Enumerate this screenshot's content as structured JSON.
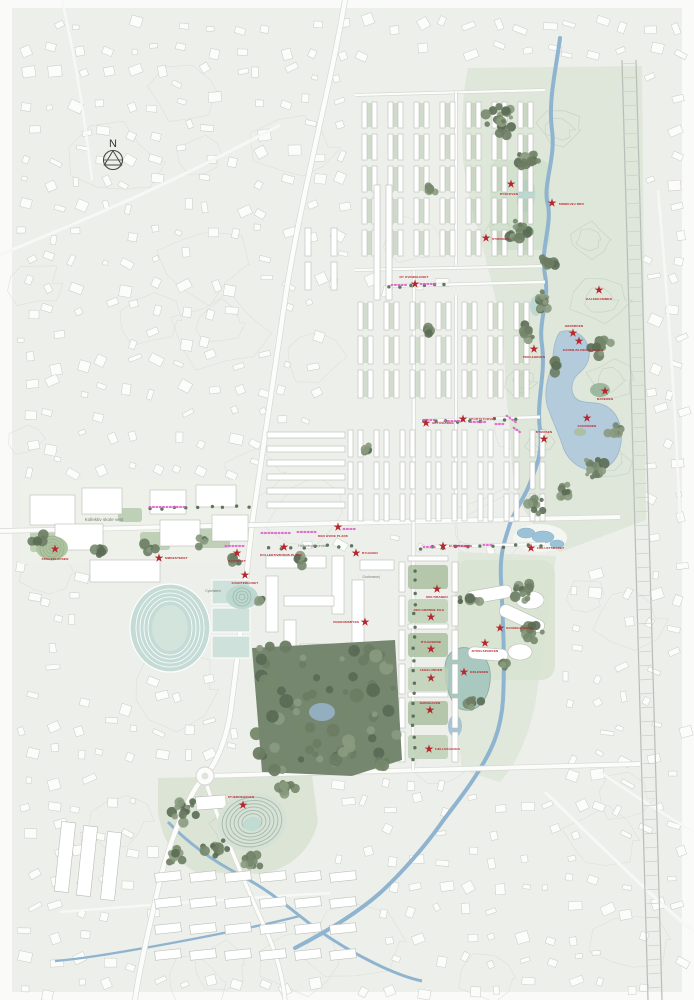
{
  "map": {
    "title": "masterplan-site-map",
    "compass": {
      "label": "N"
    },
    "colors": {
      "page_bg": "#fafaf8",
      "map_bg": "#edefeb",
      "accent_red": "#b5272d",
      "pink": "#dd5fc9",
      "river": "#8fb4cf",
      "lake": "#b3cbdb",
      "teal_pond": "#bcd8d0",
      "park_green": "#dfe6da",
      "forest_green": "#76876f",
      "building_fill": "#ffffff",
      "building_stroke": "#b8bdb6",
      "contour": "#d9dcd5"
    },
    "area_labels": [
      {
        "x": 104,
        "y": 521,
        "text": "Kollektiv skole vest",
        "size": 4.6
      },
      {
        "x": 313,
        "y": 547,
        "text": "Helhedsplancentret",
        "size": 3.4
      },
      {
        "x": 371,
        "y": 578,
        "text": "Gudrunsvej",
        "size": 3.4
      },
      {
        "x": 213,
        "y": 592,
        "text": "Cykelstien",
        "size": 3.4
      }
    ],
    "star_markers": [
      {
        "x": 511,
        "y": 184,
        "label": "BYSKOVEN",
        "lx": 509,
        "ly": 195,
        "anchor": "middle"
      },
      {
        "x": 552,
        "y": 203,
        "label": "MINDEVEJ BRO",
        "lx": 559,
        "ly": 205,
        "anchor": "start"
      },
      {
        "x": 486,
        "y": 238,
        "label": "STIBROEN",
        "lx": 492,
        "ly": 240,
        "anchor": "start"
      },
      {
        "x": 415,
        "y": 284,
        "label": "NY KVINDEHUSET",
        "lx": 414,
        "ly": 278,
        "anchor": "middle"
      },
      {
        "x": 599,
        "y": 290,
        "label": "KALKEDAMMEN",
        "lx": 599,
        "ly": 300,
        "anchor": "middle"
      },
      {
        "x": 573,
        "y": 333,
        "label": "HØJBROEN",
        "lx": 574,
        "ly": 327,
        "anchor": "middle"
      },
      {
        "x": 579,
        "y": 341,
        "label": "KAREN-BLIXENPLADSEN",
        "lx": 583,
        "ly": 351,
        "anchor": "middle"
      },
      {
        "x": 534,
        "y": 349,
        "label": "PERLEHØJEN",
        "lx": 534,
        "ly": 358,
        "anchor": "middle"
      },
      {
        "x": 605,
        "y": 391,
        "label": "BADEØEN",
        "lx": 605,
        "ly": 400,
        "anchor": "middle"
      },
      {
        "x": 587,
        "y": 418,
        "label": "KANOSØEN",
        "lx": 587,
        "ly": 427,
        "anchor": "middle"
      },
      {
        "x": 426,
        "y": 423,
        "label": "AKTIVGADEN",
        "lx": 432,
        "ly": 424,
        "anchor": "start"
      },
      {
        "x": 463,
        "y": 419,
        "label": "SPORTSTORVET",
        "lx": 469,
        "ly": 420,
        "anchor": "start"
      },
      {
        "x": 544,
        "y": 439,
        "label": "BYMOSEN",
        "lx": 544,
        "ly": 433,
        "anchor": "middle"
      },
      {
        "x": 338,
        "y": 527,
        "label": "DEN HVIDE PLADS",
        "lx": 333,
        "ly": 537,
        "anchor": "middle"
      },
      {
        "x": 443,
        "y": 546,
        "label": "KUNSTGADEN",
        "lx": 449,
        "ly": 547,
        "anchor": "start"
      },
      {
        "x": 531,
        "y": 548,
        "label": "FRILUFTSBADET",
        "lx": 537,
        "ly": 549,
        "anchor": "start"
      },
      {
        "x": 284,
        "y": 547,
        "label": "KOLLEKTIVBYENS PLADS",
        "lx": 281,
        "ly": 556,
        "anchor": "middle"
      },
      {
        "x": 356,
        "y": 553,
        "label": "BYHAVEN",
        "lx": 362,
        "ly": 554,
        "anchor": "start"
      },
      {
        "x": 237,
        "y": 553,
        "label": "BYTORVET",
        "lx": 237,
        "ly": 562,
        "anchor": "middle"
      },
      {
        "x": 159,
        "y": 558,
        "label": "MØDESTEDET",
        "lx": 165,
        "ly": 559,
        "anchor": "start"
      },
      {
        "x": 55,
        "y": 549,
        "label": "SKOLEPLADSEN",
        "lx": 55,
        "ly": 560,
        "anchor": "middle"
      },
      {
        "x": 245,
        "y": 575,
        "label": "KVARTERHUSET",
        "lx": 245,
        "ly": 584,
        "anchor": "middle"
      },
      {
        "x": 437,
        "y": 589,
        "label": "MULTIBANEN",
        "lx": 437,
        "ly": 598,
        "anchor": "middle"
      },
      {
        "x": 365,
        "y": 622,
        "label": "UNGDOMSBYEN",
        "lx": 359,
        "ly": 623,
        "anchor": "end"
      },
      {
        "x": 431,
        "y": 617,
        "label": "DEN GRØNNE KILE",
        "lx": 429,
        "ly": 611,
        "anchor": "middle"
      },
      {
        "x": 500,
        "y": 628,
        "label": "SANSEHAVERNE",
        "lx": 506,
        "ly": 629,
        "anchor": "start"
      },
      {
        "x": 431,
        "y": 649,
        "label": "BYHAVERNE",
        "lx": 431,
        "ly": 643,
        "anchor": "middle"
      },
      {
        "x": 485,
        "y": 643,
        "label": "BYDELSPARKEN",
        "lx": 485,
        "ly": 652,
        "anchor": "middle"
      },
      {
        "x": 464,
        "y": 672,
        "label": "KØLESØEN",
        "lx": 470,
        "ly": 673,
        "anchor": "start"
      },
      {
        "x": 431,
        "y": 678,
        "label": "LEGELUNDEN",
        "lx": 431,
        "ly": 671,
        "anchor": "middle"
      },
      {
        "x": 430,
        "y": 710,
        "label": "NABOHAVEN",
        "lx": 430,
        "ly": 704,
        "anchor": "middle"
      },
      {
        "x": 429,
        "y": 749,
        "label": "FÆLLESHAVEN",
        "lx": 435,
        "ly": 750,
        "anchor": "start"
      },
      {
        "x": 243,
        "y": 805,
        "label": "STJERNEHØJEN",
        "lx": 241,
        "ly": 798,
        "anchor": "middle"
      }
    ],
    "pink_markers": [
      {
        "x": 150,
        "y": 507,
        "w": 36
      },
      {
        "x": 392,
        "y": 285,
        "w": 16
      },
      {
        "x": 421,
        "y": 284,
        "w": 15
      },
      {
        "x": 262,
        "y": 533,
        "w": 28
      },
      {
        "x": 298,
        "y": 532,
        "w": 17
      },
      {
        "x": 344,
        "y": 529,
        "w": 11
      },
      {
        "x": 226,
        "y": 546,
        "w": 20
      },
      {
        "x": 424,
        "y": 547,
        "w": 13
      },
      {
        "x": 455,
        "y": 546,
        "w": 15
      },
      {
        "x": 484,
        "y": 545,
        "w": 10
      },
      {
        "x": 424,
        "y": 420,
        "w": 13
      },
      {
        "x": 445,
        "y": 421,
        "w": 19
      },
      {
        "x": 471,
        "y": 422,
        "w": 15
      },
      {
        "x": 496,
        "y": 424,
        "w": 10
      },
      {
        "x": 507,
        "y": 416,
        "w": 11,
        "angle": 35
      },
      {
        "x": 514,
        "y": 428,
        "w": 10,
        "angle": 35
      }
    ]
  }
}
